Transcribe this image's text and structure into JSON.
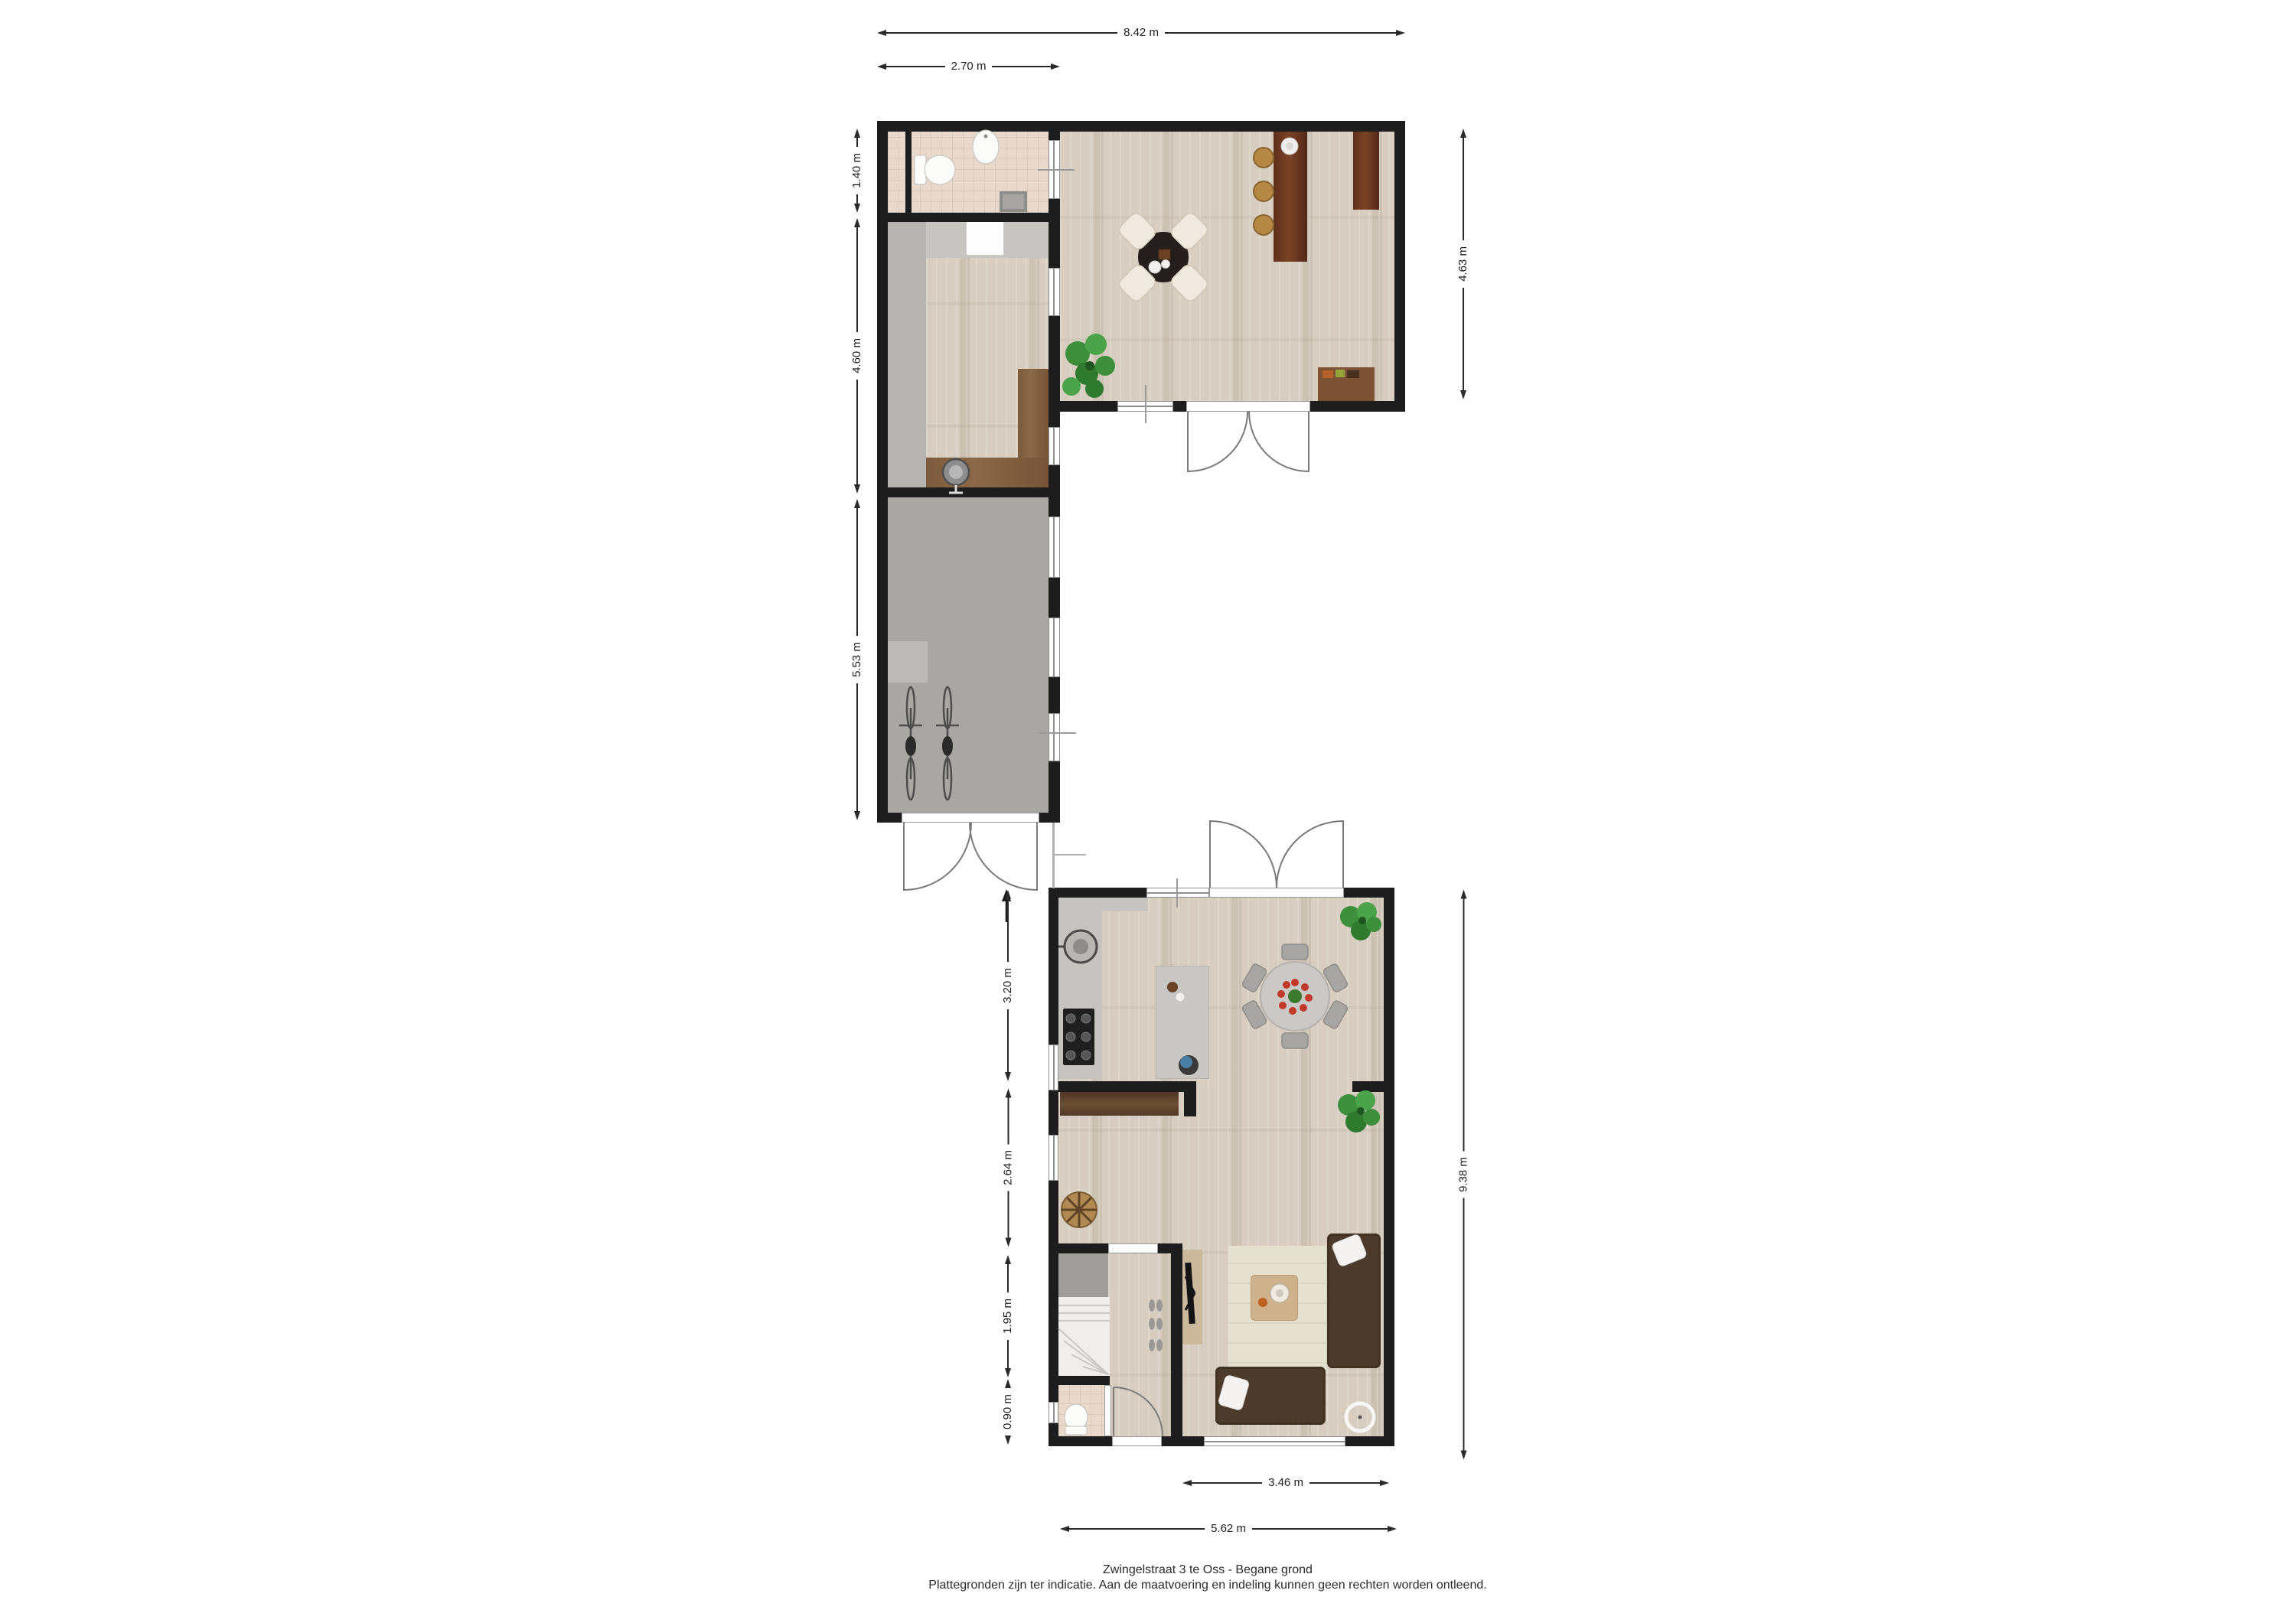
{
  "meta": {
    "title": "Zwingelstraat 3 te Oss - Begane grond",
    "disclaimer": "Plattegronden zijn ter indicatie. Aan de maatvoering en indeling kunnen geen rechten worden ontleend."
  },
  "dimensions": {
    "top_width_total": "8.42 m",
    "top_width_wing": "2.70 m",
    "left_bathroom_h": "1.40 m",
    "left_hall_h": "4.60 m",
    "left_garage_h": "5.53 m",
    "right_upper_h": "4.63 m",
    "right_lower_h": "9.38 m",
    "lower_kitchen_h": "3.20 m",
    "lower_sitting_h": "2.64 m",
    "lower_hall_h": "1.95 m",
    "lower_toilet_h": "0.90 m",
    "bottom_living_w": "3.46 m",
    "bottom_total_w": "5.62 m"
  },
  "colors": {
    "wall": "#1d1d1d",
    "wood_floor": "#d7cec1",
    "tile_floor": "#e9d9cc",
    "concrete_floor": "#a9a7a4",
    "counter_wood": "#7c5b3e",
    "bar_wood": "#5e2f1c",
    "sofa_brown": "#4c3b2c",
    "plant_green": "#3d8f3c"
  }
}
